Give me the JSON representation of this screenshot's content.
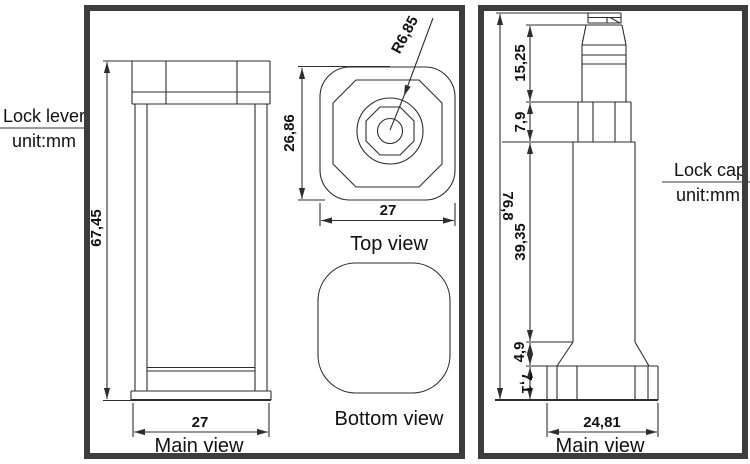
{
  "labels": {
    "left_title": "Lock lever",
    "left_unit": "unit:mm",
    "right_title": "Lock cap",
    "right_unit": "unit:mm",
    "left_main_view": "Main view",
    "top_view": "Top view",
    "bottom_view": "Bottom view",
    "right_main_view": "Main view"
  },
  "dims": {
    "lever_height": "67,45",
    "lever_width": "27",
    "lever_top_height": "26,86",
    "lever_top_width": "27",
    "lever_top_radius": "R6,85",
    "cap_total_height": "76,8",
    "cap_knob_height": "15,25",
    "cap_knurl_height": "7,9",
    "cap_body_height": "39,35",
    "cap_flare_height": "4,9",
    "cap_base_height": "7,1",
    "cap_base_width": "24,81"
  },
  "colors": {
    "line": "#2e2e2e",
    "frame_border": "#3d3d3d",
    "divider": "#9b9b9b",
    "text": "#111111",
    "background": "#ffffff"
  }
}
